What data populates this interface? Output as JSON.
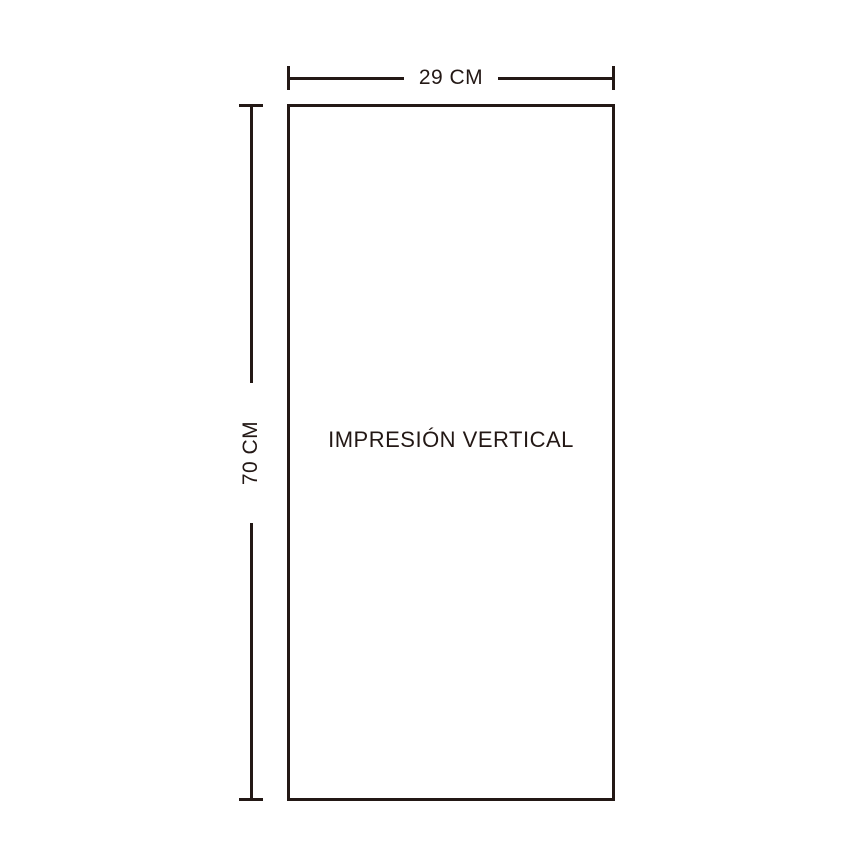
{
  "diagram": {
    "title": "vertical print dimension diagram",
    "width_dimension": {
      "label": "29 CM",
      "value": 29,
      "unit": "CM"
    },
    "height_dimension": {
      "label": "70 CM",
      "value": 70,
      "unit": "CM"
    },
    "panel_label": "IMPRESIÓN VERTICAL"
  },
  "colors": {
    "line": "#231815",
    "background": "#ffffff"
  }
}
